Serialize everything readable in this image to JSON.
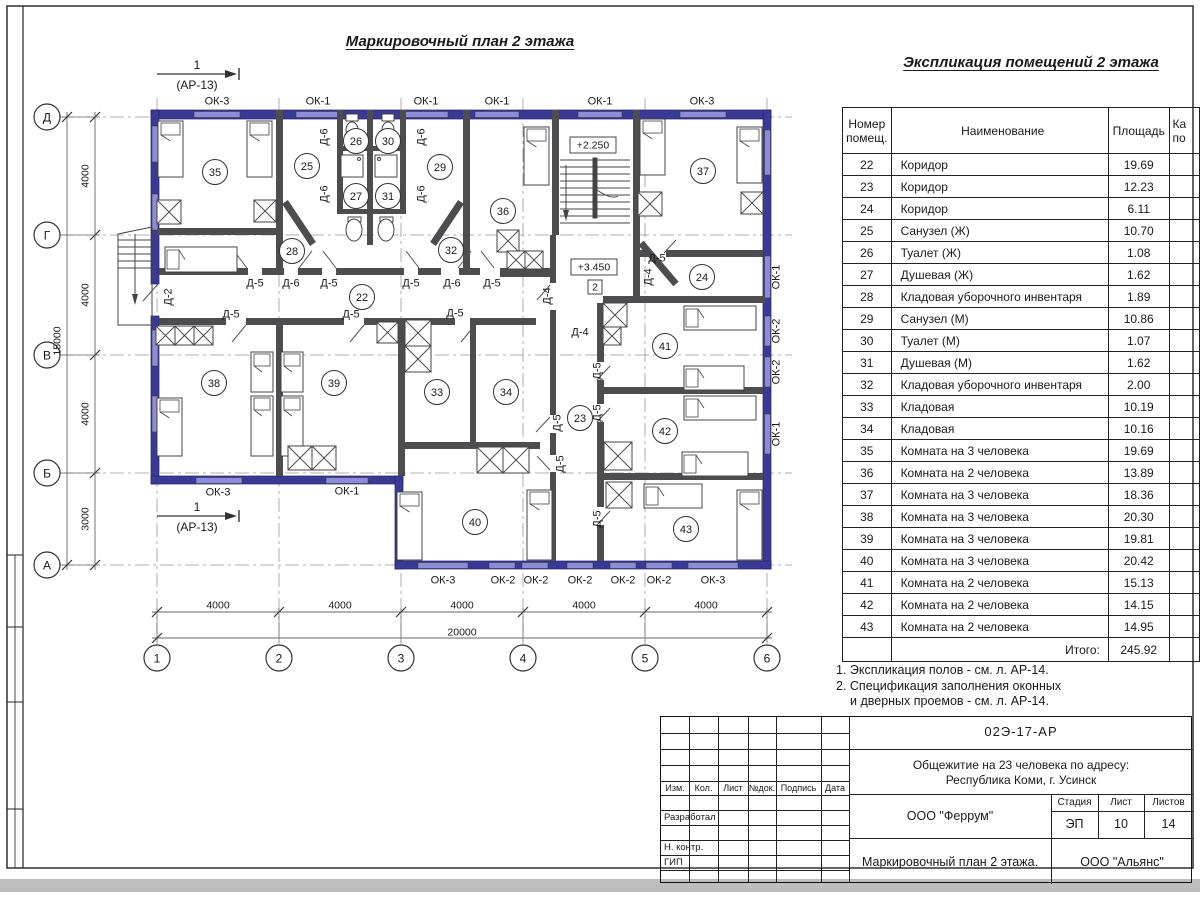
{
  "titles": {
    "plan": "Маркировочный план 2 этажа",
    "table": "Экспликация помещений 2 этажа"
  },
  "table": {
    "col_num_l1": "Номер",
    "col_num_l2": "помещ.",
    "col_name": "Наименование",
    "col_area": "Площадь",
    "col_cat_l1": "Ка",
    "col_cat_l2": "по",
    "rows": [
      [
        "22",
        "Коридор",
        "19.69"
      ],
      [
        "23",
        "Коридор",
        "12.23"
      ],
      [
        "24",
        "Коридор",
        "6.11"
      ],
      [
        "25",
        "Санузел (Ж)",
        "10.70"
      ],
      [
        "26",
        "Туалет (Ж)",
        "1.08"
      ],
      [
        "27",
        "Душевая (Ж)",
        "1.62"
      ],
      [
        "28",
        "Кладовая уборочного инвентаря",
        "1.89"
      ],
      [
        "29",
        "Санузел (М)",
        "10.86"
      ],
      [
        "30",
        "Туалет (М)",
        "1.07"
      ],
      [
        "31",
        "Душевая (М)",
        "1.62"
      ],
      [
        "32",
        "Кладовая уборочного инвентаря",
        "2.00"
      ],
      [
        "33",
        "Кладовая",
        "10.19"
      ],
      [
        "34",
        "Кладовая",
        "10.16"
      ],
      [
        "35",
        "Комната на 3 человека",
        "19.69"
      ],
      [
        "36",
        "Комната на 2 человека",
        "13.89"
      ],
      [
        "37",
        "Комната на 3 человека",
        "18.36"
      ],
      [
        "38",
        "Комната на 3 человека",
        "20.30"
      ],
      [
        "39",
        "Комната на 3 человека",
        "19.81"
      ],
      [
        "40",
        "Комната на 3 человека",
        "20.42"
      ],
      [
        "41",
        "Комната на 2 человека",
        "15.13"
      ],
      [
        "42",
        "Комната на 2 человека",
        "14.15"
      ],
      [
        "43",
        "Комната на 2 человека",
        "14.95"
      ]
    ],
    "total_label": "Итого:",
    "total": "245.92"
  },
  "notes": [
    "1. Экспликация полов - см. л. АР-14.",
    "2. Спецификация заполнения оконных",
    "и дверных проемов - см. л. АР-14."
  ],
  "stamp": {
    "doc_number": "02Э-17-АР",
    "object_line1": "Общежитие на 23 человека по адресу:",
    "object_line2": "Республика Коми, г. Усинск",
    "designer": "ООО \"Феррум\"",
    "sheet_title": "Маркировочный план 2 этажа.",
    "contractor": "ООО \"Альянс\"",
    "stage_label": "Стадия",
    "sheet_label": "Лист",
    "sheets_label": "Листов",
    "stage": "ЭП",
    "sheet": "10",
    "sheets": "14",
    "header_cells": [
      "Изм.",
      "Кол.",
      "Лист",
      "№док.",
      "Подпись",
      "Дата"
    ],
    "role_rows": [
      "Разработал",
      "Н. контр.",
      "ГИП"
    ]
  },
  "plan": {
    "axis_rows": [
      {
        "l": "Д",
        "y": 117
      },
      {
        "l": "Г",
        "y": 235
      },
      {
        "l": "В",
        "y": 355
      },
      {
        "l": "Б",
        "y": 473
      },
      {
        "l": "А",
        "y": 565
      }
    ],
    "axis_cols": [
      {
        "l": "1",
        "x": 157
      },
      {
        "l": "2",
        "x": 279
      },
      {
        "l": "3",
        "x": 401
      },
      {
        "l": "4",
        "x": 523
      },
      {
        "l": "5",
        "x": 645
      },
      {
        "l": "6",
        "x": 767
      }
    ],
    "dims": [
      {
        "t": "4000",
        "x": 85,
        "y": 176,
        "r": -90
      },
      {
        "t": "4000",
        "x": 85,
        "y": 295,
        "r": -90
      },
      {
        "t": "4000",
        "x": 85,
        "y": 414,
        "r": -90
      },
      {
        "t": "3000",
        "x": 85,
        "y": 519,
        "r": -90
      },
      {
        "t": "15000",
        "x": 57,
        "y": 341,
        "r": -90
      },
      {
        "t": "4000",
        "x": 218,
        "y": 605
      },
      {
        "t": "4000",
        "x": 340,
        "y": 605
      },
      {
        "t": "4000",
        "x": 462,
        "y": 605
      },
      {
        "t": "4000",
        "x": 584,
        "y": 605
      },
      {
        "t": "4000",
        "x": 706,
        "y": 605
      },
      {
        "t": "20000",
        "x": 462,
        "y": 632
      }
    ],
    "rooms": [
      {
        "n": "35",
        "x": 215,
        "y": 172
      },
      {
        "n": "25",
        "x": 307,
        "y": 166
      },
      {
        "n": "26",
        "x": 356,
        "y": 141
      },
      {
        "n": "30",
        "x": 388,
        "y": 141
      },
      {
        "n": "27",
        "x": 356,
        "y": 196
      },
      {
        "n": "31",
        "x": 388,
        "y": 196
      },
      {
        "n": "29",
        "x": 440,
        "y": 167
      },
      {
        "n": "36",
        "x": 503,
        "y": 211
      },
      {
        "n": "37",
        "x": 703,
        "y": 171
      },
      {
        "n": "28",
        "x": 292,
        "y": 251
      },
      {
        "n": "32",
        "x": 451,
        "y": 250
      },
      {
        "n": "22",
        "x": 362,
        "y": 297
      },
      {
        "n": "24",
        "x": 702,
        "y": 277
      },
      {
        "n": "38",
        "x": 214,
        "y": 383
      },
      {
        "n": "39",
        "x": 334,
        "y": 383
      },
      {
        "n": "33",
        "x": 437,
        "y": 392
      },
      {
        "n": "34",
        "x": 506,
        "y": 392
      },
      {
        "n": "23",
        "x": 580,
        "y": 418
      },
      {
        "n": "41",
        "x": 665,
        "y": 346
      },
      {
        "n": "42",
        "x": 665,
        "y": 431
      },
      {
        "n": "40",
        "x": 475,
        "y": 522
      },
      {
        "n": "43",
        "x": 686,
        "y": 529
      }
    ],
    "labels": [
      {
        "t": "ОК-3",
        "x": 217,
        "y": 101
      },
      {
        "t": "ОК-1",
        "x": 318,
        "y": 101
      },
      {
        "t": "ОК-1",
        "x": 426,
        "y": 101
      },
      {
        "t": "ОК-1",
        "x": 497,
        "y": 101
      },
      {
        "t": "ОК-1",
        "x": 600,
        "y": 101
      },
      {
        "t": "ОК-3",
        "x": 702,
        "y": 101
      },
      {
        "t": "ОК-3",
        "x": 218,
        "y": 492
      },
      {
        "t": "ОК-1",
        "x": 347,
        "y": 491
      },
      {
        "t": "ОК-3",
        "x": 443,
        "y": 580
      },
      {
        "t": "ОК-2",
        "x": 503,
        "y": 580
      },
      {
        "t": "ОК-2",
        "x": 536,
        "y": 580
      },
      {
        "t": "ОК-2",
        "x": 580,
        "y": 580
      },
      {
        "t": "ОК-2",
        "x": 623,
        "y": 580
      },
      {
        "t": "ОК-2",
        "x": 659,
        "y": 580
      },
      {
        "t": "ОК-3",
        "x": 713,
        "y": 580
      },
      {
        "t": "ОК-1",
        "x": 776,
        "y": 277,
        "r": -90
      },
      {
        "t": "ОК-2",
        "x": 776,
        "y": 331,
        "r": -90
      },
      {
        "t": "ОК-2",
        "x": 776,
        "y": 372,
        "r": -90
      },
      {
        "t": "ОК-1",
        "x": 776,
        "y": 434,
        "r": -90
      },
      {
        "t": "Д-5",
        "x": 255,
        "y": 283
      },
      {
        "t": "Д-6",
        "x": 291,
        "y": 283
      },
      {
        "t": "Д-5",
        "x": 329,
        "y": 283
      },
      {
        "t": "Д-5",
        "x": 411,
        "y": 283
      },
      {
        "t": "Д-6",
        "x": 452,
        "y": 283
      },
      {
        "t": "Д-5",
        "x": 492,
        "y": 283
      },
      {
        "t": "Д-5",
        "x": 231,
        "y": 314
      },
      {
        "t": "Д-5",
        "x": 351,
        "y": 314
      },
      {
        "t": "Д-5",
        "x": 455,
        "y": 313
      },
      {
        "t": "Д-5",
        "x": 657,
        "y": 258
      },
      {
        "t": "Д-4",
        "x": 580,
        "y": 332
      },
      {
        "t": "Д-6",
        "x": 324,
        "y": 137,
        "r": -90
      },
      {
        "t": "Д-6",
        "x": 421,
        "y": 137,
        "r": -90
      },
      {
        "t": "Д-6",
        "x": 324,
        "y": 194,
        "r": -90
      },
      {
        "t": "Д-6",
        "x": 421,
        "y": 194,
        "r": -90
      },
      {
        "t": "Д-2",
        "x": 168,
        "y": 297,
        "r": -90
      },
      {
        "t": "Д-4",
        "x": 547,
        "y": 296,
        "r": -90
      },
      {
        "t": "Д-4",
        "x": 648,
        "y": 277,
        "r": -90
      },
      {
        "t": "Д-5",
        "x": 557,
        "y": 423,
        "r": -90
      },
      {
        "t": "Д-5",
        "x": 560,
        "y": 464,
        "r": -90
      },
      {
        "t": "Д-5",
        "x": 597,
        "y": 371,
        "r": -90
      },
      {
        "t": "Д-5",
        "x": 597,
        "y": 413,
        "r": -90
      },
      {
        "t": "Д-5",
        "x": 597,
        "y": 519,
        "r": -90
      }
    ],
    "elevations": [
      {
        "t": "+2.250",
        "x": 593,
        "y": 145,
        "w": 46,
        "h": 16
      },
      {
        "t": "+3.450",
        "x": 594,
        "y": 267,
        "w": 46,
        "h": 16
      },
      {
        "t": "2",
        "x": 595,
        "y": 287,
        "w": 14,
        "h": 14
      }
    ],
    "section_markers": [
      {
        "num": "1",
        "ref": "(АР-13)",
        "x": 197,
        "y": 74
      },
      {
        "num": "1",
        "ref": "(АР-13)",
        "x": 197,
        "y": 516
      }
    ]
  },
  "colors": {
    "outer_wall": "#3a3a95",
    "window": "#8c8cd8",
    "inner_wall": "#4d4d50",
    "line": "#444444"
  }
}
